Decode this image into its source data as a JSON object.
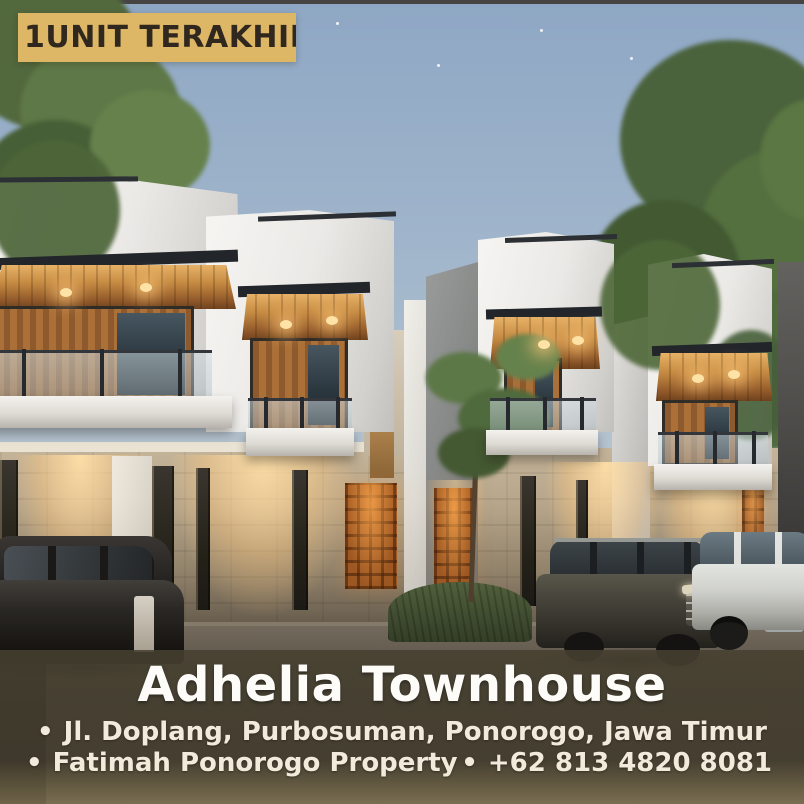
{
  "badge": {
    "label": "1UNIT TERAKHIR"
  },
  "caption": {
    "title": "Adhelia Townhouse",
    "address": "Jl. Doplang, Purbosuman, Ponorogo, Jawa Timur",
    "brand": "Fatimah Ponorogo Property",
    "phone": "+62 813 4820 8081",
    "bullet": "•"
  },
  "colors": {
    "badge_bg": "#ddb765",
    "badge_text": "#30281f",
    "overlay_bg": "#46402f",
    "title_color": "#fdfcf9",
    "subtitle_color": "#f2ebdc",
    "sky_top": "#8ea7c4",
    "wood_accent": "#c68b43",
    "roster_glow": "#d98f43"
  }
}
